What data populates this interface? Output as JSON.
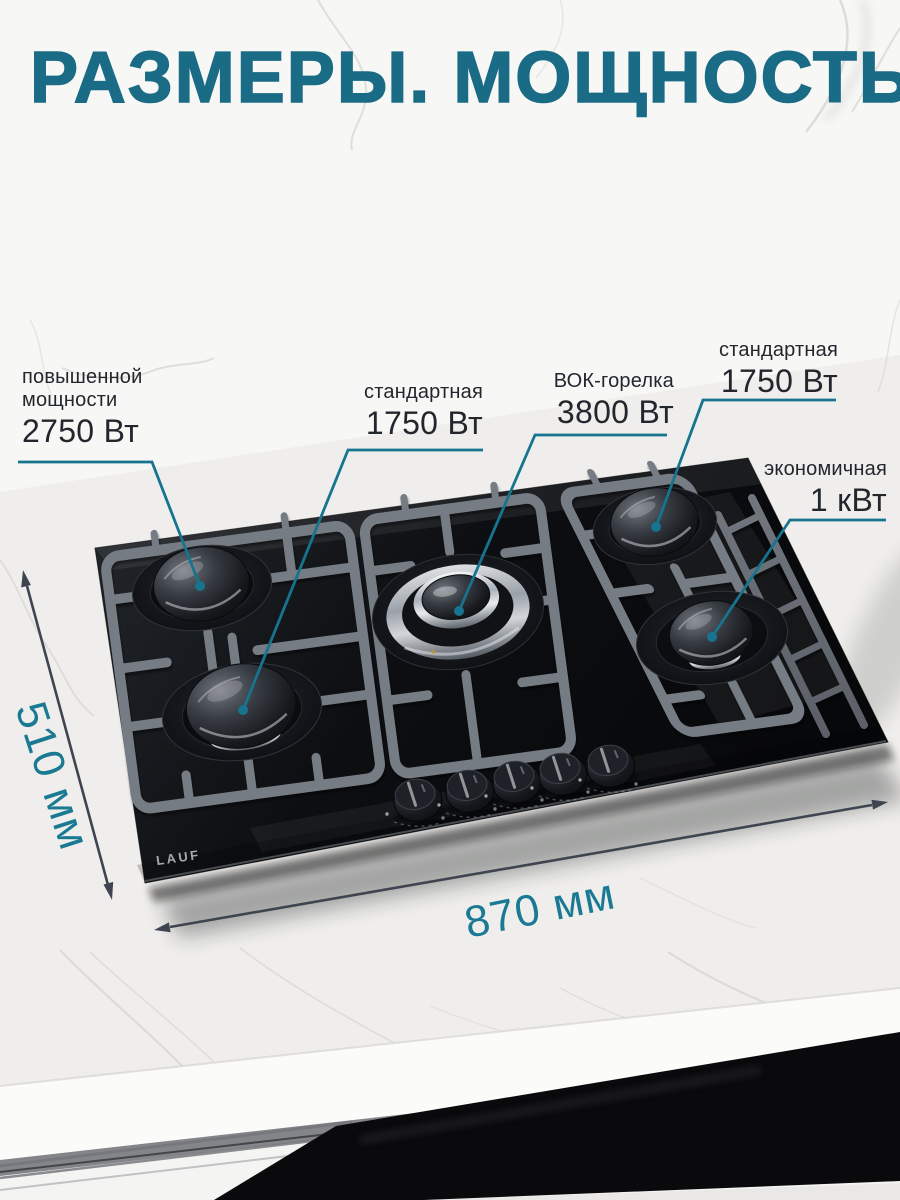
{
  "title": "РАЗМЕРЫ. МОЩНОСТЬ",
  "brand": "LAUF",
  "callouts": [
    {
      "id": "high-power",
      "burner": "back-left",
      "lines": [
        "повышенной",
        "мощности"
      ],
      "value": "2750 Вт"
    },
    {
      "id": "standard-left",
      "burner": "front-left",
      "lines": [
        "стандартная"
      ],
      "value": "1750 Вт"
    },
    {
      "id": "wok",
      "burner": "center",
      "lines": [
        "ВОК-горелка"
      ],
      "value": "3800 Вт"
    },
    {
      "id": "standard-right",
      "burner": "back-right",
      "lines": [
        "стандартная"
      ],
      "value": "1750 Вт"
    },
    {
      "id": "economy",
      "burner": "front-right",
      "lines": [
        "экономичная"
      ],
      "value": "1 кВт"
    }
  ],
  "dimensions": {
    "depth": "510 мм",
    "width": "870 мм"
  },
  "colors": {
    "accent_title": "#1a6b85",
    "callout_line": "#17748e",
    "label_text": "#23262c",
    "dimension_text": "#1b7a93",
    "dimension_arrow": "#3f4550",
    "hob_glass": "#0c0e11",
    "grate_gray": "#5d626a"
  }
}
